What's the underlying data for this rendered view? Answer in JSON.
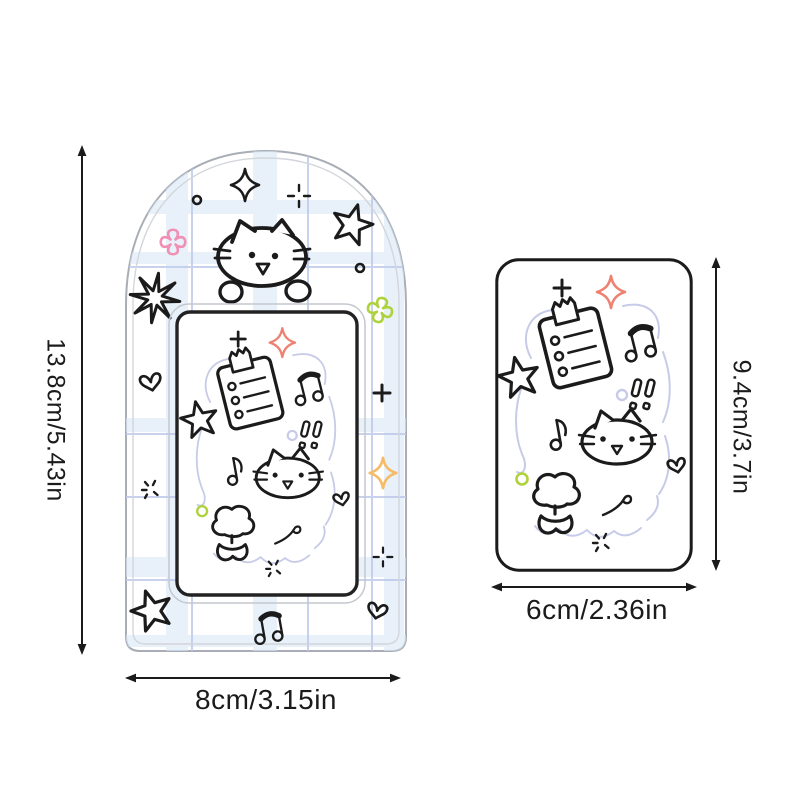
{
  "scene": {
    "type": "product dimension diagram",
    "background": "#ffffff"
  },
  "items": [
    {
      "name": "arch photocard holder",
      "height_label": "13.8cm/5.43in",
      "width_label": "8cm/3.15in"
    },
    {
      "name": "photocard insert",
      "height_label": "9.4cm/3.7in",
      "width_label": "6cm/2.36in"
    }
  ],
  "colors": {
    "ink": "#1b1b1b",
    "shell_outline": "#a9aeb6",
    "plaid_band": "#d9e8f6",
    "plaid_line": "#bfcaec",
    "cloud_lavender": "#c7cbe8",
    "clover_pink": "#f090b4",
    "accent_green": "#aed23c",
    "sparkle_coral": "#ee8272",
    "sparkle_orange": "#f5bb67"
  },
  "decorations": [
    "cat-face",
    "cat-peeking",
    "clipboard-checklist",
    "music-notes",
    "star",
    "heart",
    "clover",
    "four-point-sparkle",
    "burst-star",
    "flower",
    "double-exclamation",
    "squiggle",
    "plus",
    "dashed-plus",
    "dashed-asterisk",
    "dot-circle",
    "plaid-grid",
    "cloud-frame"
  ]
}
